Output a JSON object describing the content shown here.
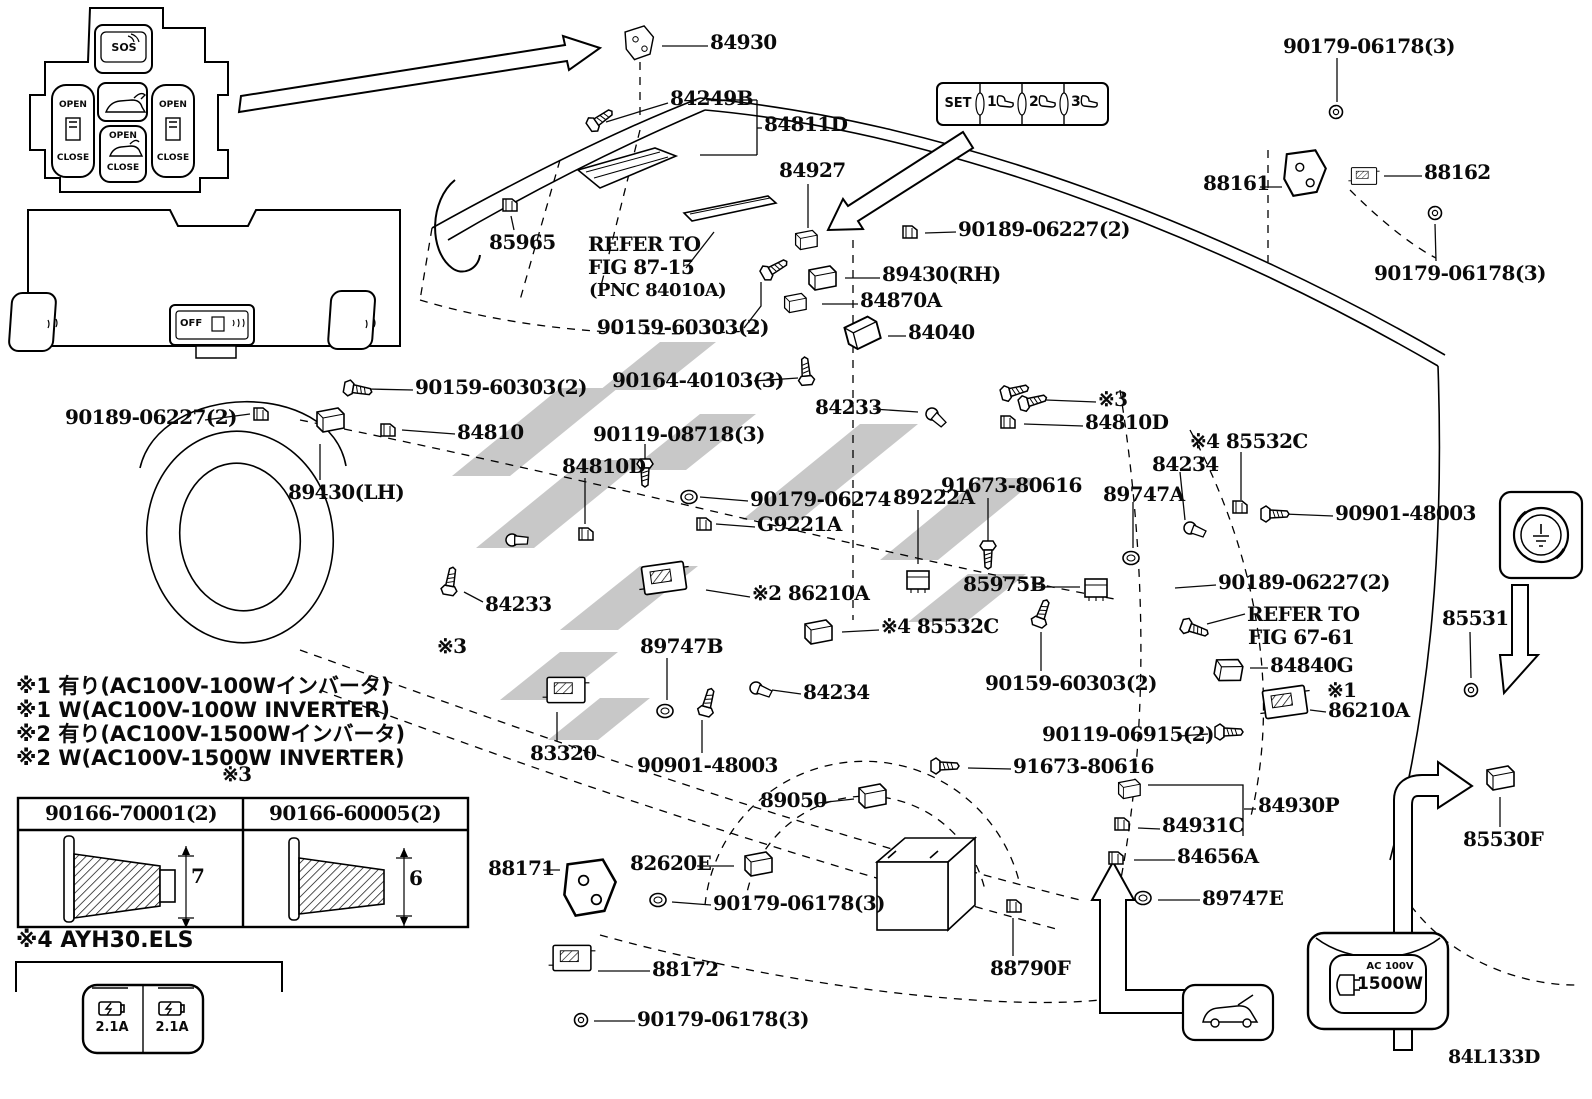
{
  "diagram_code": "84L133D",
  "watermark_color": "#c8c8c8",
  "console_panel": {
    "sos": "SOS",
    "left_open": "OPEN",
    "left_close": "CLOSE",
    "center_open": "OPEN",
    "center_close": "CLOSE",
    "right_open": "OPEN",
    "right_close": "CLOSE"
  },
  "lower_panel": {
    "off_label": "OFF"
  },
  "memory_panel": {
    "set": "SET",
    "n1": "1",
    "n2": "2",
    "n3": "3"
  },
  "usb_panel": {
    "left_amp": "2.1A",
    "right_amp": "2.1A"
  },
  "outlet_icon": {
    "line1": "AC 100V",
    "line2": "1500W"
  },
  "screw_table": {
    "headers": [
      "90166-70001(2)",
      "90166-60005(2)"
    ],
    "dims": [
      "7",
      "6"
    ]
  },
  "part_labels": [
    {
      "t": "84930",
      "x": 710,
      "y": 32,
      "lead": [
        708,
        46,
        662,
        46
      ]
    },
    {
      "t": "84249B",
      "x": 670,
      "y": 88,
      "lead": [
        668,
        103,
        606,
        122
      ]
    },
    {
      "t": "84811D",
      "x": 764,
      "y": 114,
      "lead": [
        762,
        128,
        757,
        128
      ]
    },
    {
      "t": "84927",
      "x": 779,
      "y": 160,
      "lead": [
        808,
        184,
        808,
        228
      ]
    },
    {
      "t": "90179-06178(3)",
      "x": 1283,
      "y": 36,
      "lead": [
        1337,
        58,
        1337,
        102
      ]
    },
    {
      "t": "88161",
      "x": 1203,
      "y": 173,
      "lead": [
        1260,
        187,
        1282,
        187
      ]
    },
    {
      "t": "88162",
      "x": 1424,
      "y": 162,
      "lead": [
        1422,
        176,
        1384,
        176
      ]
    },
    {
      "t": "90179-06178(3)",
      "x": 1374,
      "y": 263,
      "lead": [
        1436,
        261,
        1435,
        224
      ]
    },
    {
      "t": "90189-06227(2)",
      "x": 958,
      "y": 219,
      "lead": [
        956,
        232,
        925,
        233
      ]
    },
    {
      "t": "89430(RH)",
      "x": 882,
      "y": 264,
      "lead": [
        880,
        278,
        845,
        278
      ]
    },
    {
      "t": "84870A",
      "x": 860,
      "y": 290,
      "lead": [
        858,
        304,
        822,
        304
      ]
    },
    {
      "t": "84040",
      "x": 908,
      "y": 322,
      "lead": [
        906,
        336,
        888,
        336
      ]
    },
    {
      "t": "85965",
      "x": 489,
      "y": 232,
      "lead": [
        514,
        230,
        511,
        216
      ]
    },
    {
      "t": "REFER TO",
      "x": 588,
      "y": 234
    },
    {
      "t": "FIG 87-15",
      "x": 588,
      "y": 257,
      "lead": [
        686,
        268,
        714,
        232
      ]
    },
    {
      "t": "(PNC 84010A)",
      "x": 589,
      "y": 282,
      "fs": 18
    },
    {
      "t": "90159-60303(2)",
      "x": 597,
      "y": 317,
      "lead": [
        744,
        328,
        761,
        306,
        761,
        282
      ]
    },
    {
      "t": "90164-40103(3)",
      "x": 612,
      "y": 370,
      "lead": [
        754,
        381,
        798,
        378
      ]
    },
    {
      "t": "90119-08718(3)",
      "x": 593,
      "y": 424,
      "lead": [
        645,
        444,
        645,
        486
      ]
    },
    {
      "t": "84810D",
      "x": 562,
      "y": 456,
      "lead": [
        585,
        478,
        585,
        524
      ]
    },
    {
      "t": "90179-06274",
      "x": 750,
      "y": 489,
      "lead": [
        748,
        501,
        700,
        497
      ]
    },
    {
      "t": "G9221A",
      "x": 757,
      "y": 514,
      "lead": [
        755,
        527,
        716,
        524
      ]
    },
    {
      "t": "84233",
      "x": 815,
      "y": 397,
      "lead": [
        873,
        409,
        918,
        412
      ]
    },
    {
      "t": "※3",
      "x": 1098,
      "y": 389,
      "lead": [
        1096,
        402,
        1046,
        400
      ]
    },
    {
      "t": "84810D",
      "x": 1085,
      "y": 412,
      "lead": [
        1083,
        426,
        1024,
        424
      ]
    },
    {
      "t": "※4 85532C",
      "x": 1190,
      "y": 431,
      "lead": [
        1241,
        452,
        1241,
        500
      ]
    },
    {
      "t": "84234",
      "x": 1152,
      "y": 454,
      "lead": [
        1180,
        472,
        1185,
        520
      ]
    },
    {
      "t": "89747A",
      "x": 1103,
      "y": 484,
      "lead": [
        1133,
        502,
        1133,
        548
      ]
    },
    {
      "t": "90901-48003",
      "x": 1335,
      "y": 503,
      "lead": [
        1333,
        516,
        1284,
        514
      ]
    },
    {
      "t": "90189-06227(2)",
      "x": 65,
      "y": 407,
      "lead": [
        205,
        420,
        250,
        414
      ]
    },
    {
      "t": "84810",
      "x": 457,
      "y": 422,
      "lead": [
        455,
        434,
        402,
        430
      ]
    },
    {
      "t": "89430(LH)",
      "x": 288,
      "y": 482,
      "lead": [
        320,
        480,
        320,
        444
      ]
    },
    {
      "t": "90159-60303(2)",
      "x": 415,
      "y": 377,
      "lead": [
        413,
        390,
        368,
        389
      ]
    },
    {
      "t": "91673-80616",
      "x": 941,
      "y": 475,
      "lead": [
        988,
        498,
        988,
        542
      ]
    },
    {
      "t": "89222A",
      "x": 893,
      "y": 487,
      "lead": [
        918,
        510,
        918,
        564
      ]
    },
    {
      "t": "※2 86210A",
      "x": 752,
      "y": 583,
      "lead": [
        750,
        597,
        706,
        590
      ]
    },
    {
      "t": "85975B",
      "x": 963,
      "y": 574,
      "lead": [
        1035,
        587,
        1080,
        587
      ]
    },
    {
      "t": "90189-06227(2)",
      "x": 1218,
      "y": 572,
      "lead": [
        1216,
        585,
        1175,
        588
      ]
    },
    {
      "t": "REFER TO",
      "x": 1247,
      "y": 604,
      "lead": [
        1245,
        614,
        1207,
        624
      ]
    },
    {
      "t": "FIG 67-61",
      "x": 1248,
      "y": 627
    },
    {
      "t": "90159-60303(2)",
      "x": 985,
      "y": 673,
      "lead": [
        1041,
        671,
        1041,
        632
      ]
    },
    {
      "t": "84840G",
      "x": 1270,
      "y": 655,
      "lead": [
        1268,
        668,
        1250,
        668
      ]
    },
    {
      "t": "※4 85532C",
      "x": 881,
      "y": 616,
      "lead": [
        879,
        630,
        842,
        632
      ]
    },
    {
      "t": "89747B",
      "x": 640,
      "y": 636,
      "lead": [
        667,
        658,
        667,
        700
      ]
    },
    {
      "t": "84233",
      "x": 485,
      "y": 594,
      "lead": [
        483,
        602,
        464,
        592
      ]
    },
    {
      "t": "※3",
      "x": 437,
      "y": 636
    },
    {
      "t": "84234",
      "x": 803,
      "y": 682,
      "lead": [
        801,
        694,
        772,
        690
      ]
    },
    {
      "t": "83320",
      "x": 530,
      "y": 743,
      "lead": [
        557,
        741,
        557,
        712
      ]
    },
    {
      "t": "90901-48003",
      "x": 637,
      "y": 755,
      "lead": [
        702,
        753,
        702,
        720
      ]
    },
    {
      "t": "89050",
      "x": 760,
      "y": 790,
      "lead": [
        818,
        803,
        854,
        799
      ]
    },
    {
      "t": "91673-80616",
      "x": 1013,
      "y": 756,
      "lead": [
        1011,
        769,
        968,
        768
      ]
    },
    {
      "t": "90119-06915(2)",
      "x": 1042,
      "y": 724,
      "lead": [
        1180,
        736,
        1208,
        734
      ]
    },
    {
      "t": "※1",
      "x": 1327,
      "y": 680
    },
    {
      "t": "86210A",
      "x": 1328,
      "y": 700,
      "lead": [
        1326,
        712,
        1310,
        710
      ]
    },
    {
      "t": "84930P",
      "x": 1258,
      "y": 795,
      "lead": [
        1256,
        809,
        1244,
        809
      ]
    },
    {
      "t": "84931C",
      "x": 1162,
      "y": 815,
      "lead": [
        1160,
        829,
        1138,
        828
      ]
    },
    {
      "t": "84656A",
      "x": 1177,
      "y": 846,
      "lead": [
        1175,
        860,
        1134,
        860
      ]
    },
    {
      "t": "89747E",
      "x": 1202,
      "y": 888,
      "lead": [
        1200,
        900,
        1158,
        900
      ]
    },
    {
      "t": "85531",
      "x": 1442,
      "y": 608,
      "lead": [
        1470,
        632,
        1471,
        678
      ]
    },
    {
      "t": "85530F",
      "x": 1463,
      "y": 829,
      "lead": [
        1500,
        827,
        1500,
        797
      ]
    },
    {
      "t": "88790F",
      "x": 990,
      "y": 958,
      "lead": [
        1013,
        956,
        1013,
        918
      ]
    },
    {
      "t": "88171",
      "x": 488,
      "y": 858,
      "lead": [
        543,
        870,
        560,
        870
      ]
    },
    {
      "t": "82620E",
      "x": 630,
      "y": 853,
      "lead": [
        697,
        866,
        734,
        866
      ]
    },
    {
      "t": "90179-06178(3)",
      "x": 713,
      "y": 893,
      "lead": [
        711,
        905,
        672,
        902
      ]
    },
    {
      "t": "88172",
      "x": 652,
      "y": 959,
      "lead": [
        650,
        971,
        598,
        971
      ]
    },
    {
      "t": "90179-06178(3)",
      "x": 637,
      "y": 1009,
      "lead": [
        635,
        1021,
        594,
        1021
      ]
    },
    {
      "t": "※3",
      "x": 222,
      "y": 764
    },
    {
      "t": "※1 有り(AC100V-100Wインバータ)",
      "x": 16,
      "y": 676,
      "f": "sans",
      "fs": 21
    },
    {
      "t": "※1 W(AC100V-100W INVERTER)",
      "x": 16,
      "y": 700,
      "f": "sans",
      "fs": 21
    },
    {
      "t": "※2 有り(AC100V-1500Wインバータ)",
      "x": 16,
      "y": 724,
      "f": "sans",
      "fs": 21
    },
    {
      "t": "※2 W(AC100V-1500W INVERTER)",
      "x": 16,
      "y": 748,
      "f": "sans",
      "fs": 21
    },
    {
      "t": "※4 AYH30.ELS",
      "x": 16,
      "y": 930,
      "f": "sans",
      "fs": 22
    },
    {
      "t": "84L133D",
      "x": 1448,
      "y": 1048,
      "fs": 19
    }
  ],
  "parts": [
    {
      "s": "bracketp",
      "x": 640,
      "y": 44,
      "r": -10,
      "sc": 0.9
    },
    {
      "s": "screw",
      "x": 598,
      "y": 121,
      "r": -35
    },
    {
      "s": "switch",
      "x": 806,
      "y": 240,
      "r": 0,
      "sc": 0.8
    },
    {
      "s": "clip",
      "x": 510,
      "y": 205,
      "r": 0
    },
    {
      "s": "screw",
      "x": 772,
      "y": 270,
      "r": -30
    },
    {
      "s": "clip",
      "x": 910,
      "y": 232,
      "r": 0
    },
    {
      "s": "switch",
      "x": 822,
      "y": 278,
      "r": 0
    },
    {
      "s": "switch",
      "x": 795,
      "y": 303,
      "r": 0,
      "sc": 0.8
    },
    {
      "s": "switch",
      "x": 862,
      "y": 333,
      "r": -15,
      "sc": 1.2
    },
    {
      "s": "screw",
      "x": 806,
      "y": 374,
      "r": -95
    },
    {
      "s": "screw",
      "x": 355,
      "y": 389,
      "r": 10
    },
    {
      "s": "clip",
      "x": 261,
      "y": 414,
      "r": 0
    },
    {
      "s": "switch",
      "x": 330,
      "y": 420,
      "r": 0
    },
    {
      "s": "clip",
      "x": 388,
      "y": 430,
      "r": 0
    },
    {
      "s": "screw",
      "x": 645,
      "y": 470,
      "r": 90
    },
    {
      "s": "grommet",
      "x": 689,
      "y": 497,
      "r": 0
    },
    {
      "s": "clip",
      "x": 704,
      "y": 524,
      "r": 0
    },
    {
      "s": "module",
      "x": 664,
      "y": 578,
      "r": -8
    },
    {
      "s": "clip",
      "x": 586,
      "y": 534,
      "r": 0
    },
    {
      "s": "sensor",
      "x": 932,
      "y": 414,
      "r": 20
    },
    {
      "s": "screw",
      "x": 1012,
      "y": 392,
      "r": -15
    },
    {
      "s": "screw",
      "x": 1030,
      "y": 402,
      "r": -15
    },
    {
      "s": "clip",
      "x": 1008,
      "y": 422,
      "r": 0
    },
    {
      "s": "relay",
      "x": 918,
      "y": 580,
      "r": 0
    },
    {
      "s": "screw",
      "x": 988,
      "y": 552,
      "r": 90
    },
    {
      "s": "clip",
      "x": 1240,
      "y": 507,
      "r": 0
    },
    {
      "s": "screw",
      "x": 1272,
      "y": 514,
      "r": 0
    },
    {
      "s": "sensor",
      "x": 1190,
      "y": 528,
      "r": 0
    },
    {
      "s": "grommet",
      "x": 1131,
      "y": 558,
      "r": 0
    },
    {
      "s": "relay",
      "x": 1096,
      "y": 588,
      "r": 0
    },
    {
      "s": "screw",
      "x": 1041,
      "y": 616,
      "r": -70
    },
    {
      "s": "screw",
      "x": 1192,
      "y": 628,
      "r": 20
    },
    {
      "s": "switch",
      "x": 1228,
      "y": 670,
      "r": 10
    },
    {
      "s": "switch",
      "x": 818,
      "y": 632,
      "r": 0
    },
    {
      "s": "sensor",
      "x": 756,
      "y": 688,
      "r": 0
    },
    {
      "s": "screw",
      "x": 707,
      "y": 705,
      "r": -75
    },
    {
      "s": "grommet",
      "x": 665,
      "y": 711,
      "r": 0
    },
    {
      "s": "screw",
      "x": 450,
      "y": 584,
      "r": -80
    },
    {
      "s": "sensor",
      "x": 512,
      "y": 540,
      "r": -20
    },
    {
      "s": "module",
      "x": 566,
      "y": 690,
      "r": 0,
      "sc": 0.9
    },
    {
      "s": "module",
      "x": 1285,
      "y": 702,
      "r": -8
    },
    {
      "s": "screw",
      "x": 1226,
      "y": 732,
      "r": 0
    },
    {
      "s": "screw",
      "x": 942,
      "y": 766,
      "r": 0
    },
    {
      "s": "switch",
      "x": 872,
      "y": 796,
      "r": 0
    },
    {
      "s": "bracketp",
      "x": 590,
      "y": 890,
      "r": 0,
      "sc": 1.6
    },
    {
      "s": "switch",
      "x": 758,
      "y": 864,
      "r": 0
    },
    {
      "s": "grommet",
      "x": 658,
      "y": 900,
      "r": 0
    },
    {
      "s": "module",
      "x": 572,
      "y": 958,
      "r": 0,
      "sc": 0.9
    },
    {
      "s": "nut",
      "x": 581,
      "y": 1020,
      "r": 0
    },
    {
      "s": "clip",
      "x": 1014,
      "y": 906,
      "r": 0
    },
    {
      "s": "switch",
      "x": 1129,
      "y": 789,
      "r": 0,
      "sc": 0.8
    },
    {
      "s": "clip",
      "x": 1122,
      "y": 824,
      "r": 0
    },
    {
      "s": "clip",
      "x": 1116,
      "y": 858,
      "r": 0
    },
    {
      "s": "grommet",
      "x": 1143,
      "y": 898,
      "r": 0
    },
    {
      "s": "nut",
      "x": 1471,
      "y": 690,
      "r": 0
    },
    {
      "s": "switch",
      "x": 1500,
      "y": 778,
      "r": 0
    },
    {
      "s": "bracketp",
      "x": 1305,
      "y": 175,
      "r": 0,
      "sc": 1.3
    },
    {
      "s": "module",
      "x": 1364,
      "y": 176,
      "r": 0,
      "sc": 0.6
    },
    {
      "s": "nut",
      "x": 1336,
      "y": 112,
      "r": 0
    },
    {
      "s": "nut",
      "x": 1435,
      "y": 213,
      "r": 0
    }
  ]
}
